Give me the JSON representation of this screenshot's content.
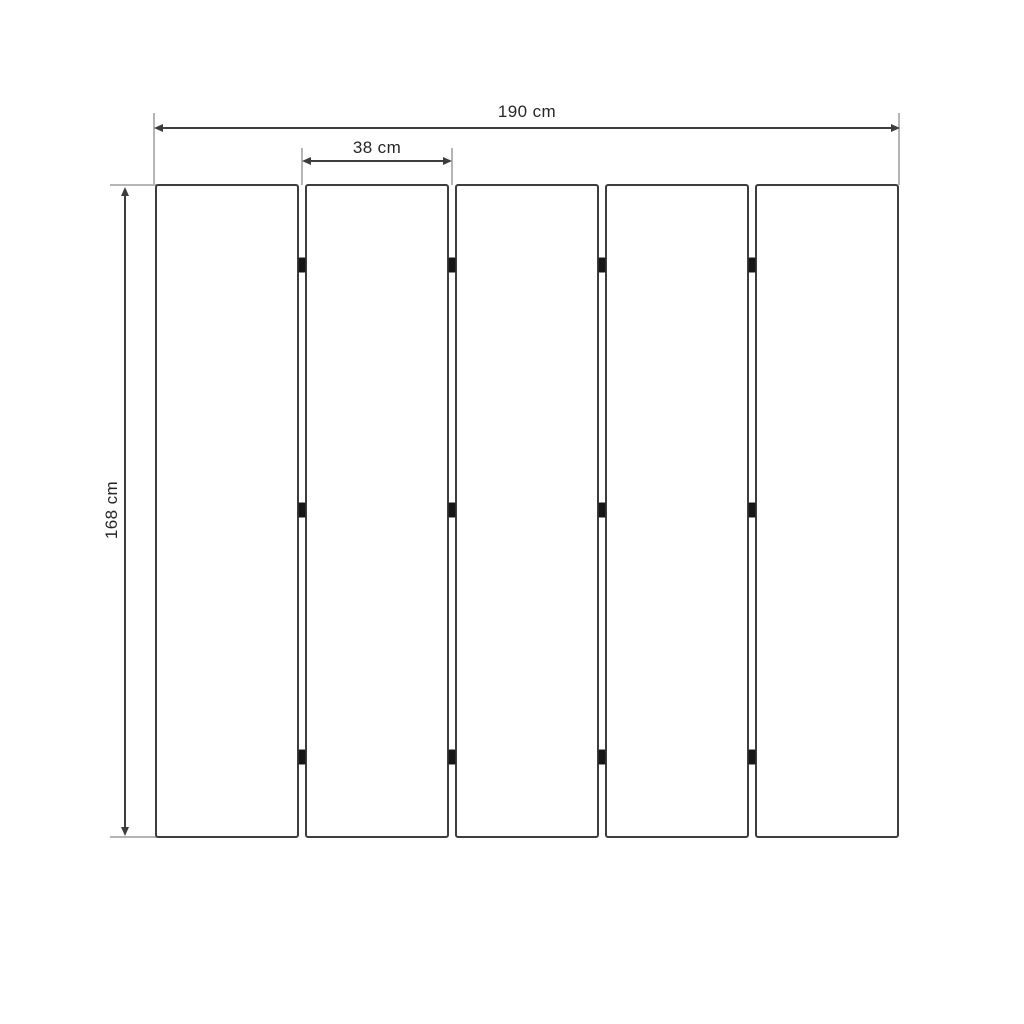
{
  "diagram": {
    "labels": {
      "total_width": "190 cm",
      "panel_width": "38 cm",
      "height": "168 cm"
    },
    "panel_count": 5,
    "hinges_per_gap": 3,
    "colors": {
      "background": "#ffffff",
      "outline": "#3d3d3d",
      "extension_line": "#b5b5b5",
      "text": "#262626",
      "hinge": "#161616"
    }
  }
}
